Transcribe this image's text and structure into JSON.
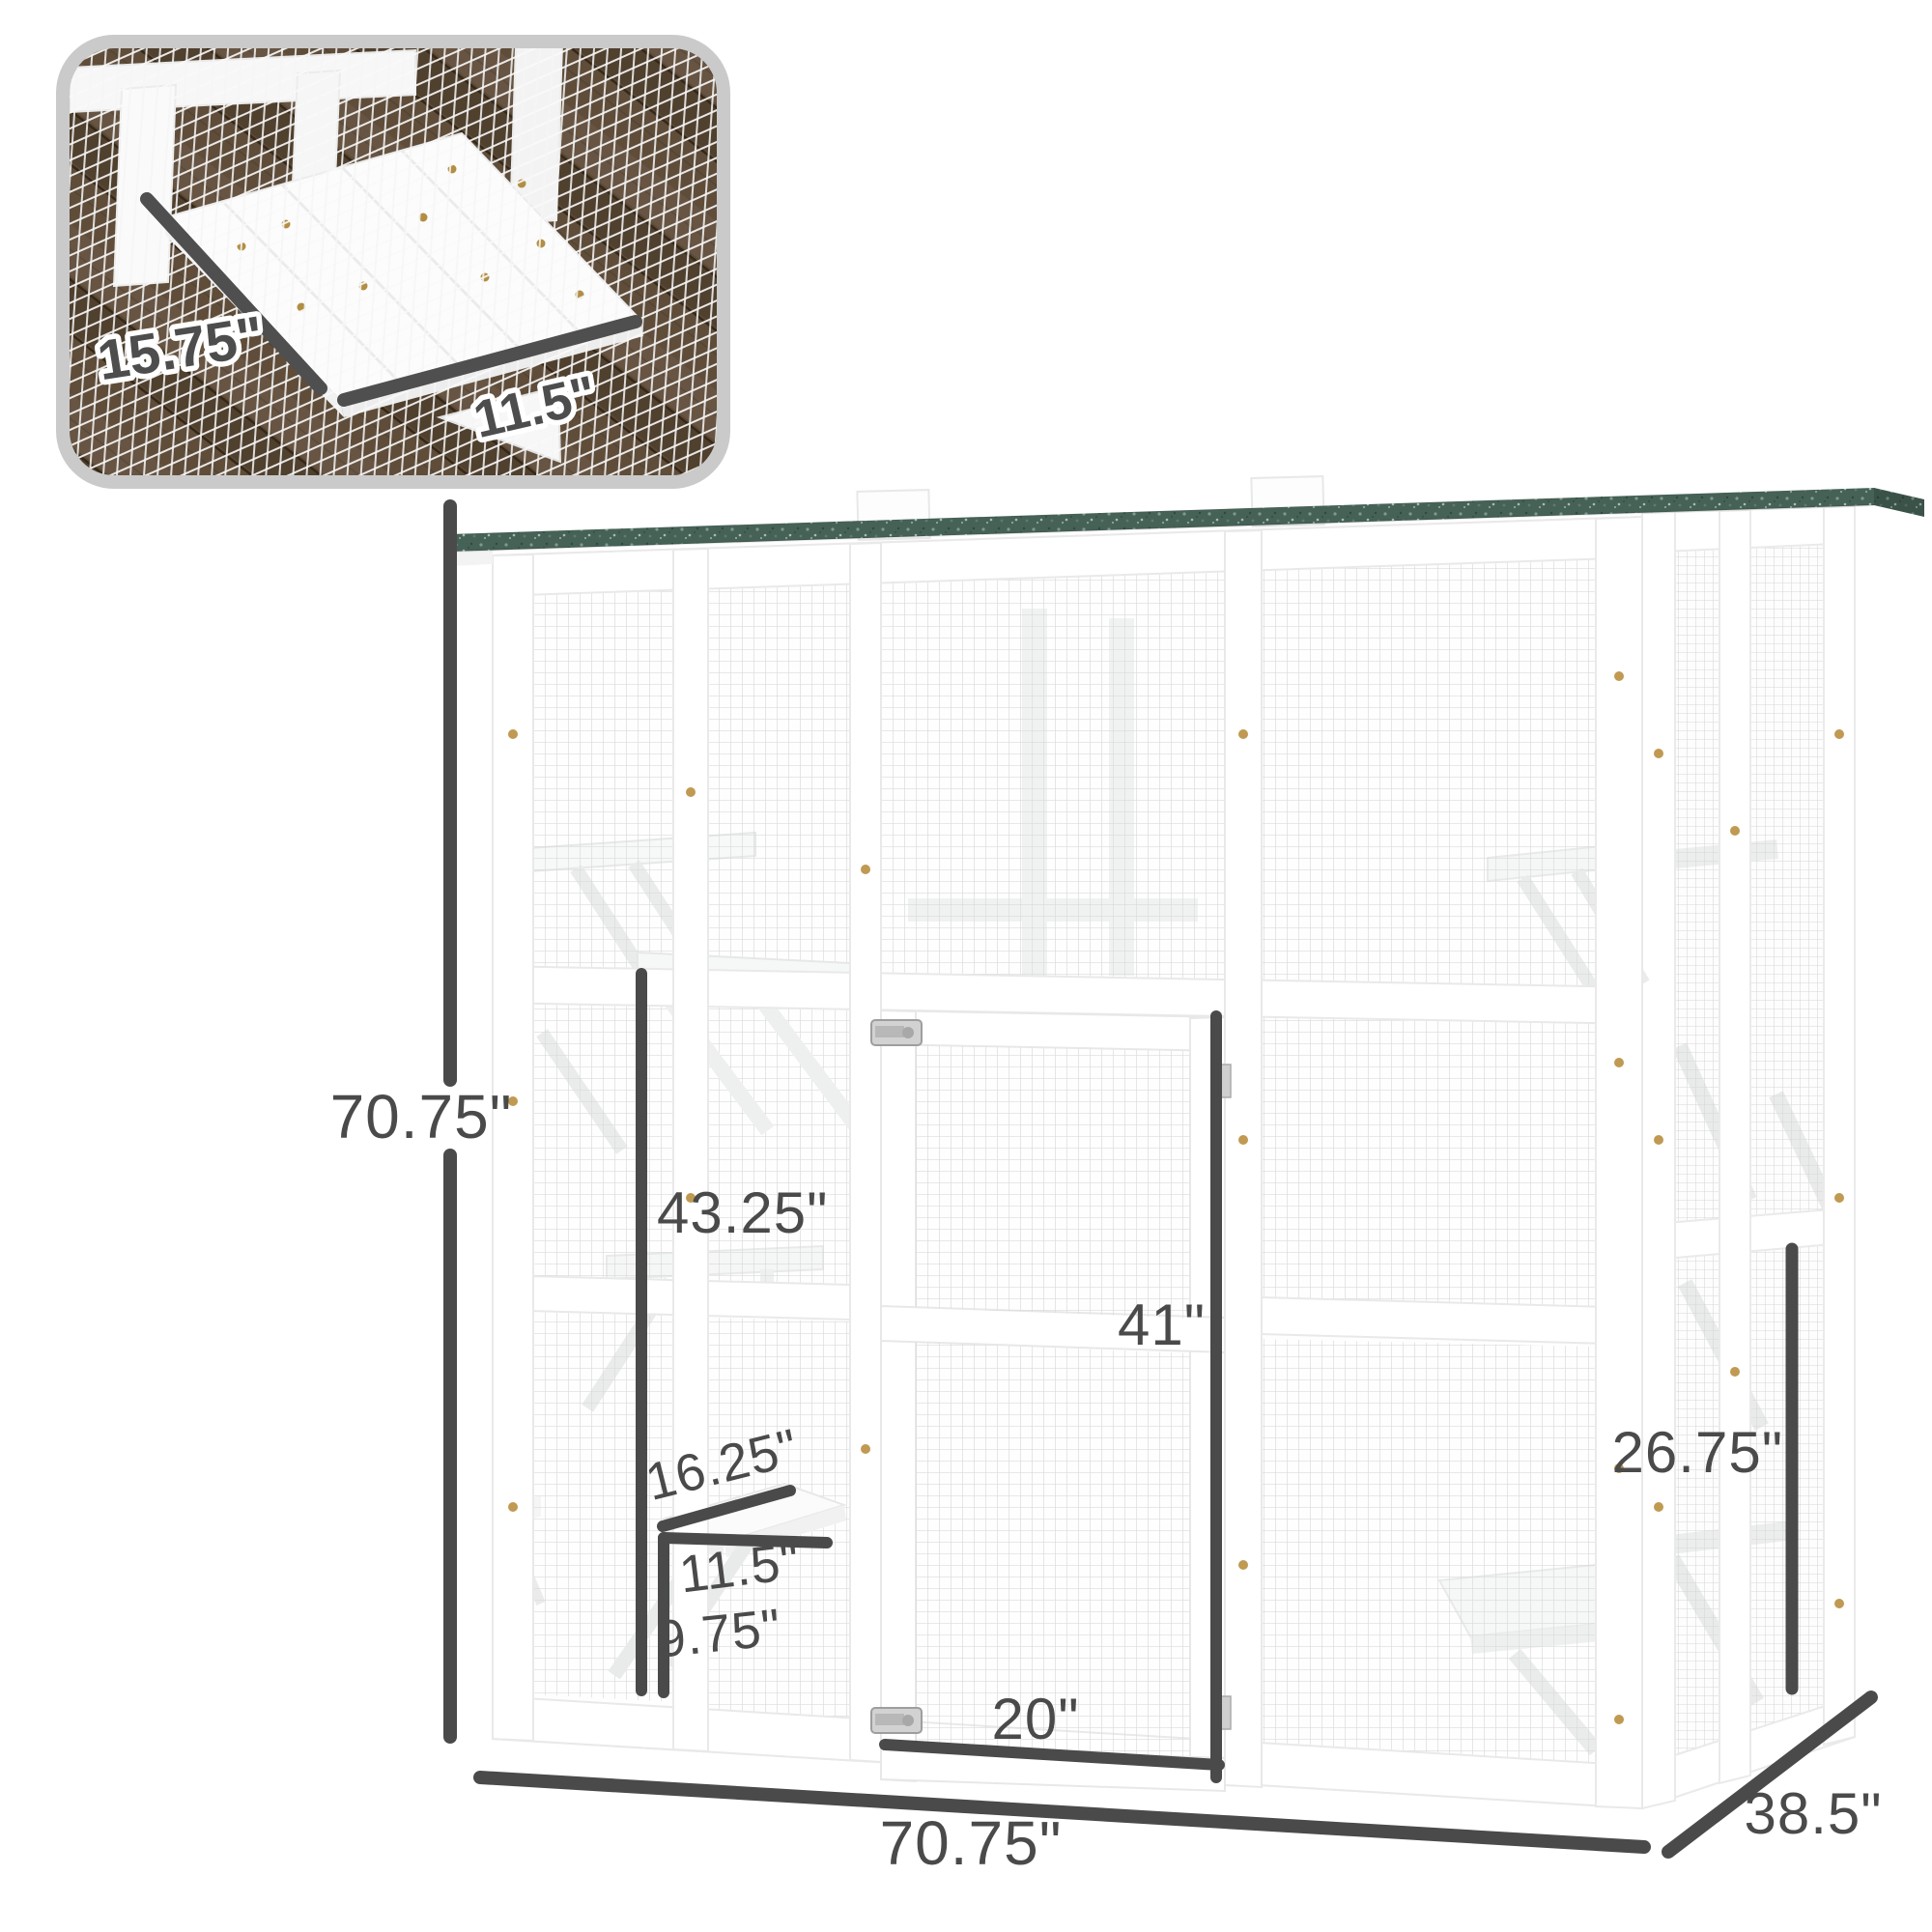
{
  "page": {
    "background": "#ffffff"
  },
  "inset": {
    "platform_depth_label": "15.75\"",
    "platform_width_label": "11.5\""
  },
  "diagram": {
    "height_label": "70.75\"",
    "width_label": "70.75\"",
    "depth_label": "38.5\"",
    "upper_platform_height_label": "43.25\"",
    "door_height_label": "41\"",
    "door_width_label": "20\"",
    "side_platform_height_label": "26.75\"",
    "platform_depth_label": "16.25\"",
    "platform_width_label": "11.5\"",
    "lower_platform_height_label": "9.75\""
  },
  "colors": {
    "dimension": "#4a4a4a",
    "roof_green": "#466156",
    "frame_white": "#ffffff",
    "mesh_line": "#dadada",
    "wood_brown": "#5c4a36",
    "inset_border": "#cacaca",
    "label_outline": "#ffffff"
  }
}
